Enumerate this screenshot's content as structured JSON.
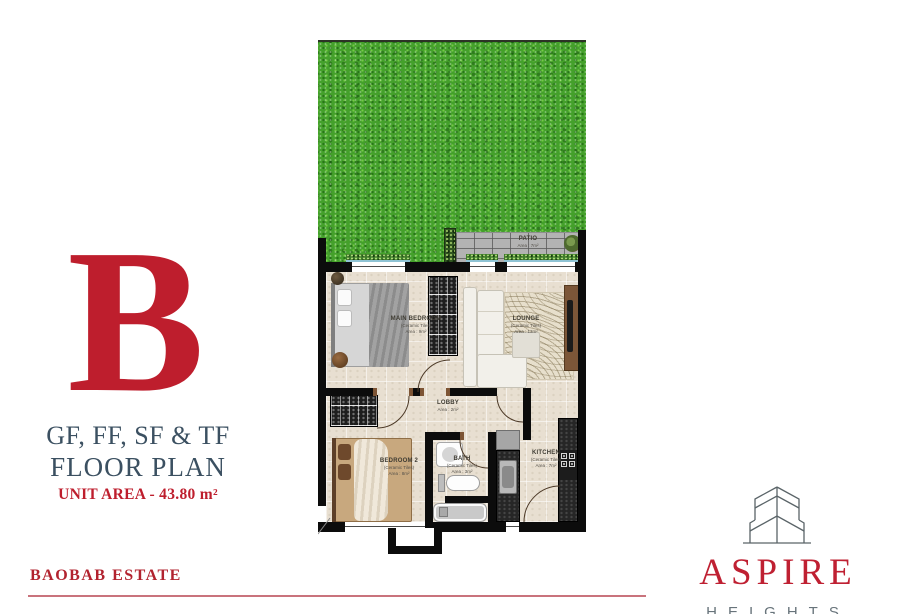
{
  "panel": {
    "letter": "B",
    "plan_levels": "GF, FF, SF & TF",
    "plan_title": "FLOOR PLAN",
    "unit_area": "UNIT AREA - 43.80 m²"
  },
  "footer": {
    "estate_name": "BAOBAB ESTATE"
  },
  "brand": {
    "name": "ASPIRE",
    "subtitle": "HEIGHTS"
  },
  "floorplan": {
    "rooms": [
      {
        "id": "patio",
        "label": "PATIO",
        "area": "Area : 7m²"
      },
      {
        "id": "main-bedroom",
        "label": "MAIN BEDROOM",
        "finish": "(Ceramic Tiles)",
        "area": "Area : 9m²"
      },
      {
        "id": "lounge",
        "label": "LOUNGE",
        "finish": "(Ceramic Tiles)",
        "area": "Area : 13m²"
      },
      {
        "id": "lobby",
        "label": "LOBBY",
        "area": "Area : 2m²"
      },
      {
        "id": "bedroom-2",
        "label": "BEDROOM 2",
        "finish": "(Ceramic Tiles)",
        "area": "Area : 8m²"
      },
      {
        "id": "bath",
        "label": "BATH",
        "finish": "(Ceramic Tiles)",
        "area": "Area : 3m²"
      },
      {
        "id": "kitchen",
        "label": "KITCHEN",
        "finish": "(Ceramic Tiles)",
        "area": "Area : 7m²"
      }
    ]
  },
  "colors": {
    "accent_red": "#be1e2d",
    "slate_blue": "#3b5061",
    "rule_pink": "#c9737c",
    "grass_green": "#44a02b",
    "wall_black": "#0c0c0c",
    "floor_beige": "#e8dfd1",
    "brand_gray": "#68747b"
  }
}
